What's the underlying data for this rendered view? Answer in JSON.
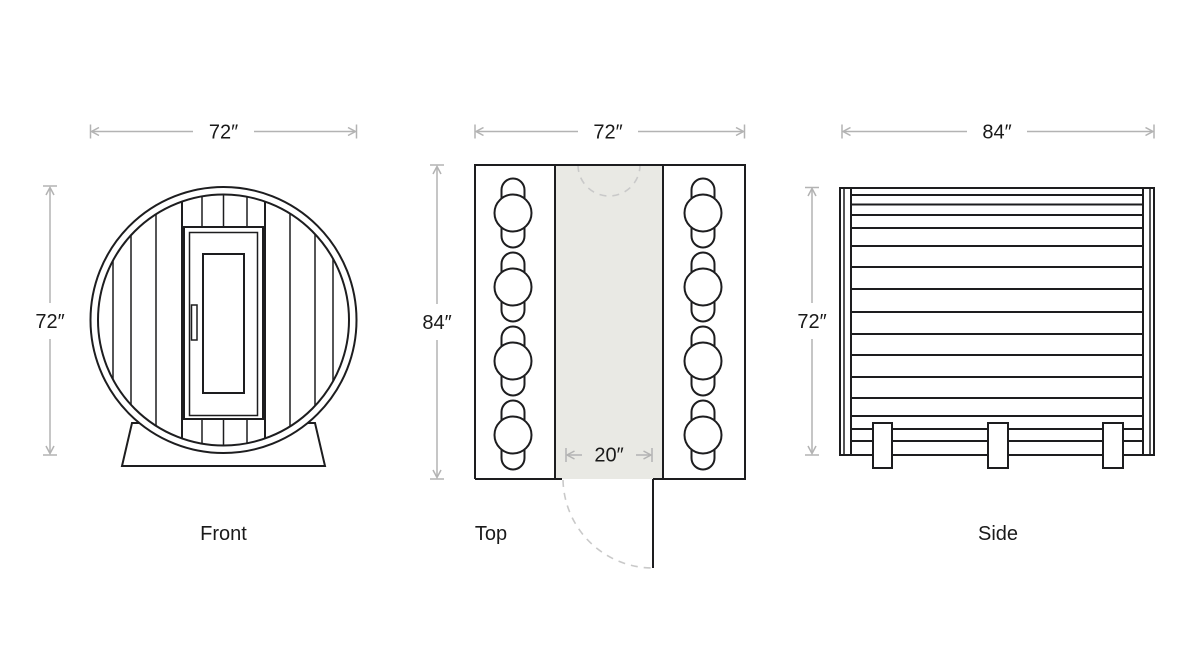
{
  "diagram": {
    "subject": "barrel-sauna-dimension-drawing",
    "views": {
      "front": {
        "label": "Front",
        "width_dim": "72″",
        "height_dim": "72″"
      },
      "top": {
        "label": "Top",
        "width_dim": "72″",
        "depth_dim": "84″",
        "door_dim": "20″"
      },
      "side": {
        "label": "Side",
        "length_dim": "84″",
        "height_dim": "72″"
      }
    },
    "colors": {
      "background": "#ffffff",
      "line": "#1d1d1f",
      "dimension_line": "#b3b3b3",
      "text": "#1a1a1a",
      "aisle_fill": "#e9e9e4",
      "dashed_line": "#c9c9c9"
    }
  }
}
